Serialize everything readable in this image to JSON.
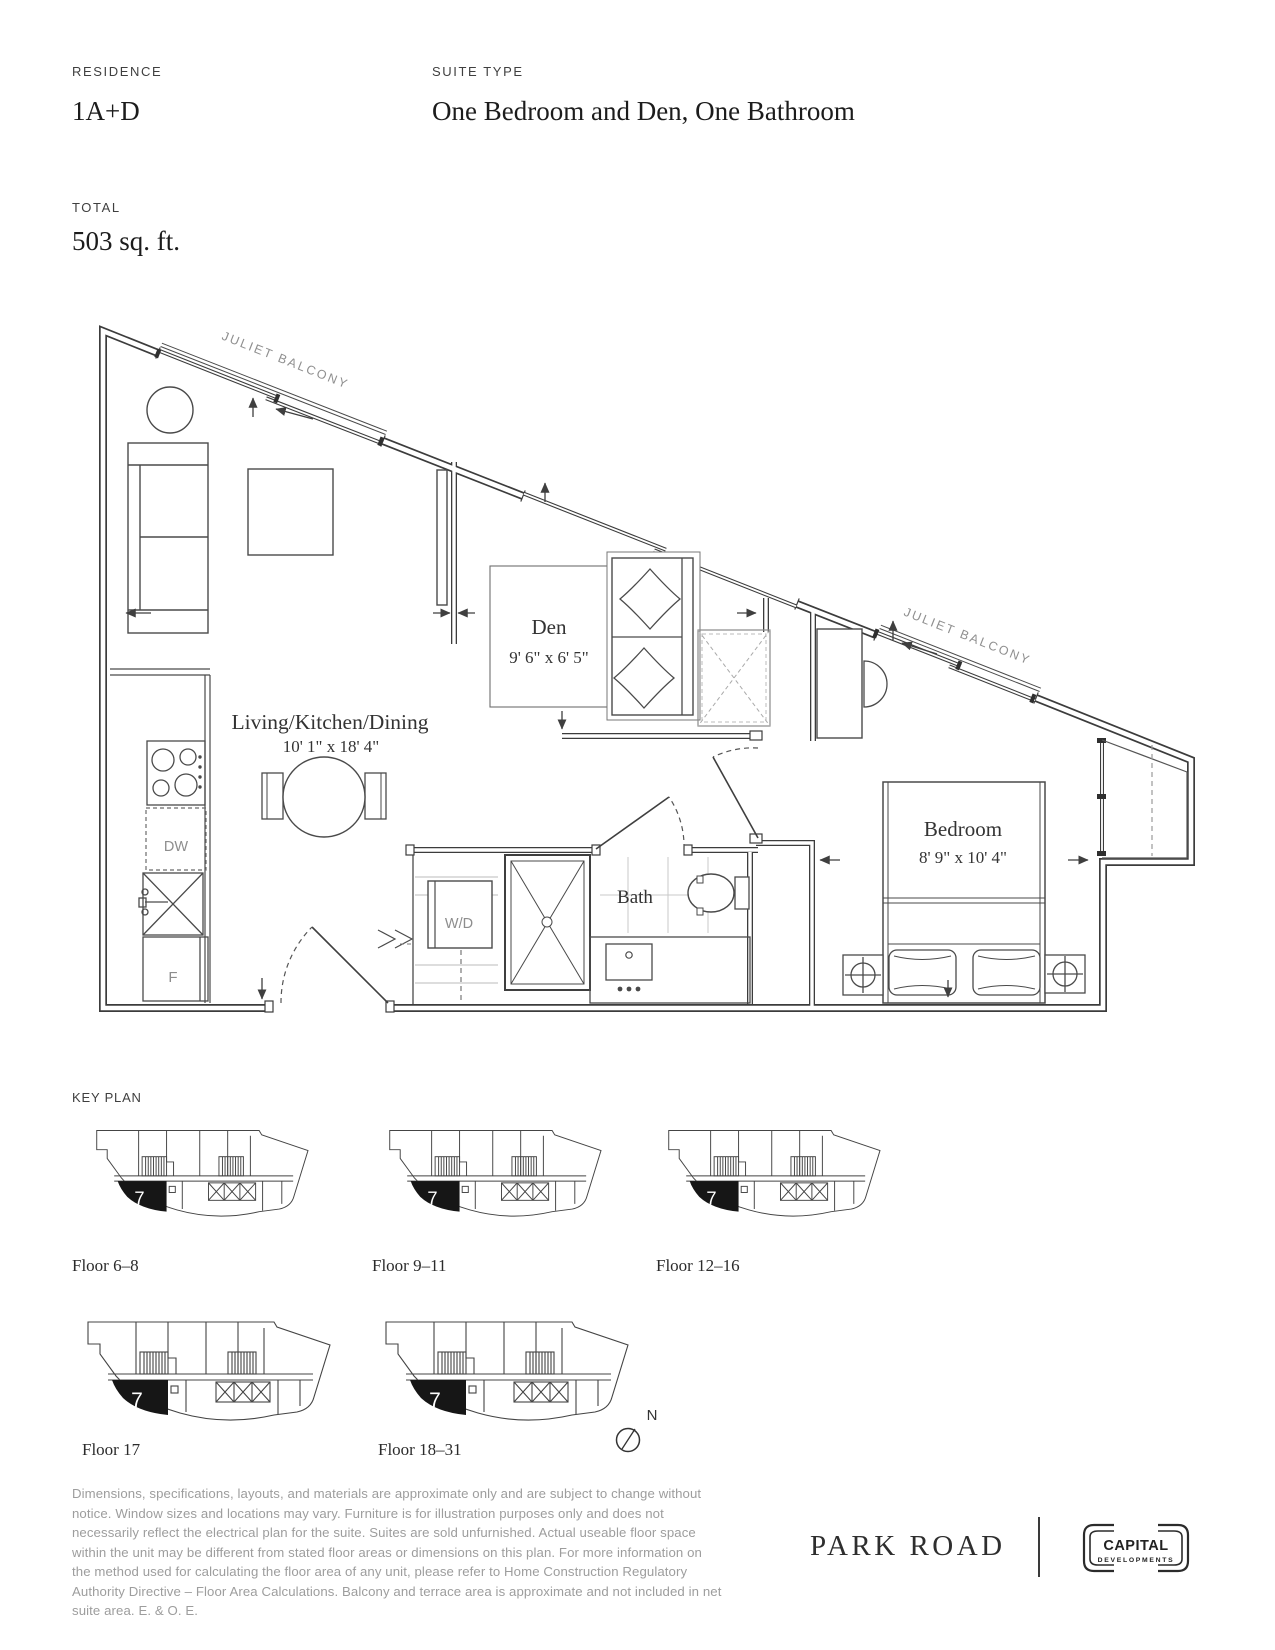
{
  "header": {
    "residence_label": "RESIDENCE",
    "residence_value": "1A+D",
    "suite_type_label": "SUITE TYPE",
    "suite_type_value": "One Bedroom and Den, One Bathroom",
    "total_label": "TOTAL",
    "total_value": "503 sq. ft."
  },
  "floor_plan": {
    "juliet_balcony_label": "JULIET BALCONY",
    "rooms": {
      "living": {
        "name": "Living/Kitchen/Dining",
        "dims": "10' 1\" x 18' 4\""
      },
      "den": {
        "name": "Den",
        "dims": "9' 6\" x 6' 5\""
      },
      "bath": {
        "name": "Bath"
      },
      "bedroom": {
        "name": "Bedroom",
        "dims": "8' 9\" x 10' 4\""
      }
    },
    "labels": {
      "dishwasher": "DW",
      "fridge": "F",
      "washer_dryer": "W/D"
    }
  },
  "key_plan": {
    "heading": "KEY PLAN",
    "unit_number": "7",
    "floors": [
      "Floor 6–8",
      "Floor 9–11",
      "Floor 12–16",
      "Floor 17",
      "Floor 18–31"
    ],
    "north_label": "N"
  },
  "disclaimer": "Dimensions, specifications, layouts, and materials are approximate only and are subject to change without notice. Window sizes and locations may vary. Furniture is for illustration purposes only and does not necessarily reflect the electrical plan for the suite. Suites are sold unfurnished. Actual useable floor space within the unit may be different from stated floor areas or dimensions on this plan. For more information on the method used for calculating the floor area of any unit, please refer to Home Construction Regulatory Authority Directive – Floor Area Calculations. Balcony and terrace area is approximate and not included in net suite area. E. & O. E.",
  "footer": {
    "brand": "PARK ROAD",
    "developer_name": "CAPITAL",
    "developer_sub": "DEVELOPMENTS"
  }
}
